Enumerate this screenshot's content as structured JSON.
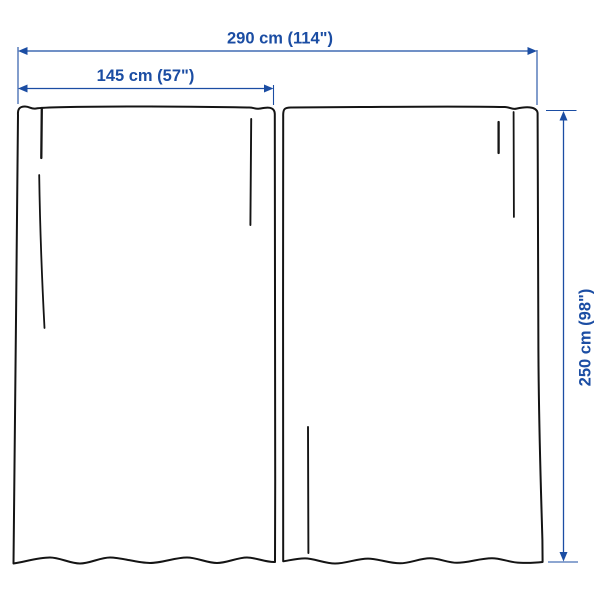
{
  "diagram": {
    "type": "product-dimension-diagram",
    "subject": "curtain panel pair",
    "panel_count": 2,
    "labels": {
      "total_width": "290 cm (114\")",
      "panel_width": "145 cm (57\")",
      "panel_height": "250 cm (98\")"
    },
    "colors": {
      "dimension_blue": "#1b4da3",
      "outline_black": "#141414",
      "background": "#ffffff"
    }
  }
}
